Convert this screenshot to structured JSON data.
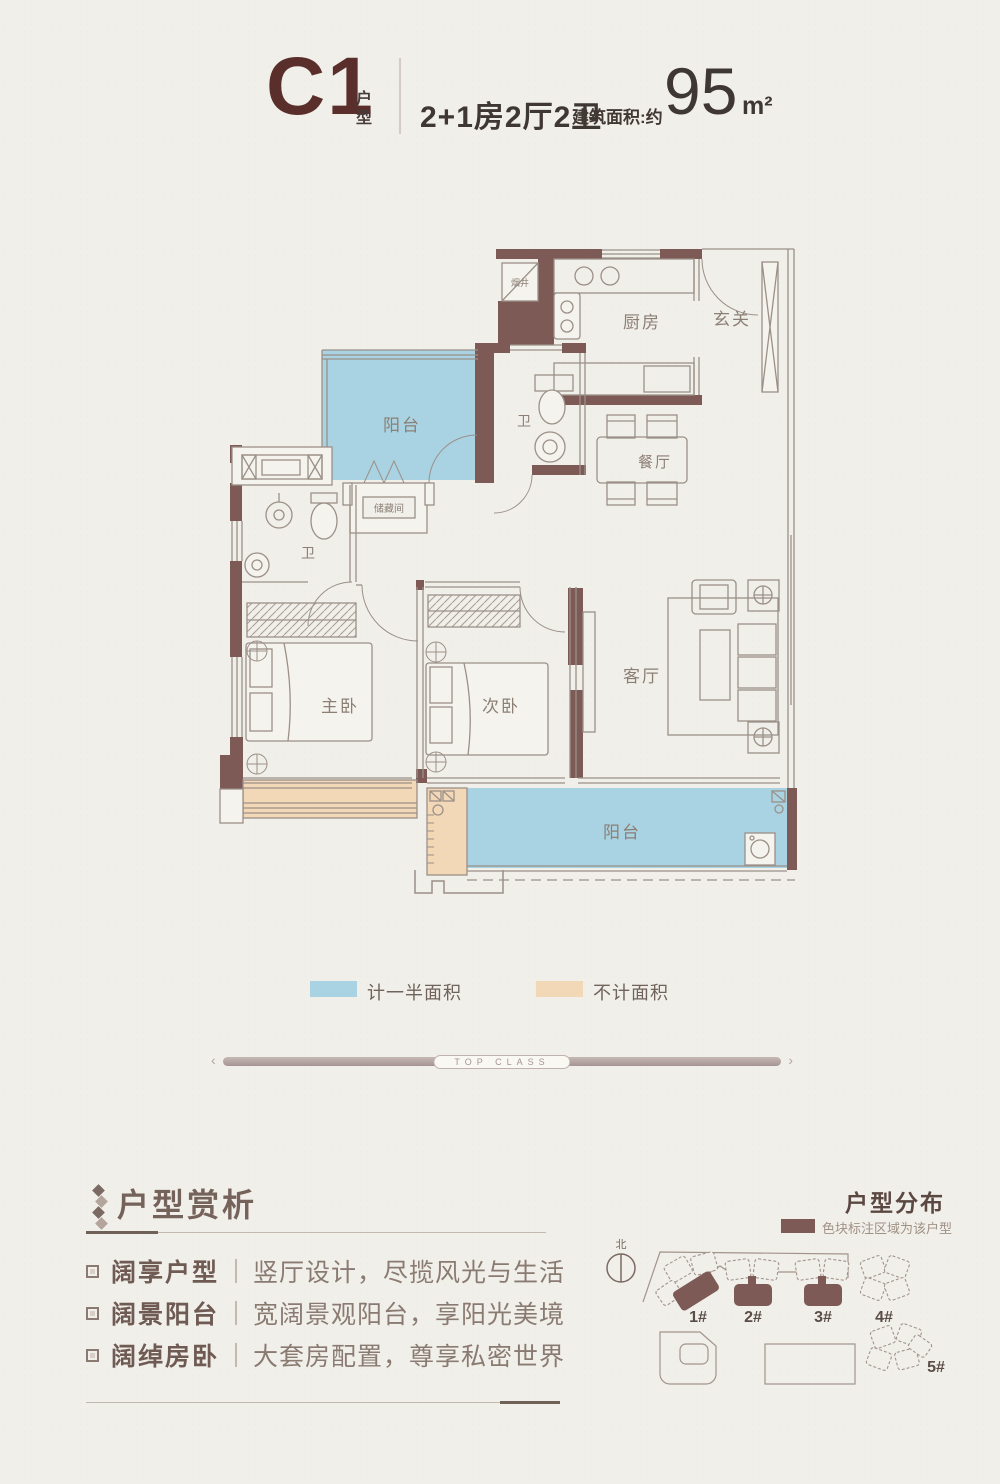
{
  "header": {
    "unit_code": "C1",
    "unit_type_line1": "户",
    "unit_type_line2": "型",
    "layout_spec": "2+1房2厅2卫",
    "area_label": "建筑面积:约",
    "area_value": "95",
    "area_unit": "m²"
  },
  "floorplan": {
    "rooms": {
      "smoke_shaft": "烟井",
      "kitchen": "厨房",
      "foyer": "玄关",
      "dining": "餐厅",
      "balcony_top": "阳台",
      "bath_main": "卫",
      "storage": "储藏间",
      "bath_left": "卫",
      "master_bedroom": "主卧",
      "second_bedroom": "次卧",
      "living": "客厅",
      "balcony_bottom": "阳台"
    },
    "colors": {
      "wall": "#7d5a55",
      "half_area_fill": "#a9d3e2",
      "excluded_fill": "#f3d8b7",
      "line": "#9b9088"
    }
  },
  "legend": {
    "items": [
      {
        "label": "计一半面积",
        "color": "#a9d3e2"
      },
      {
        "label": "不计面积",
        "color": "#f3d8b7"
      }
    ]
  },
  "divider": {
    "text": "TOP CLASS"
  },
  "analysis": {
    "title": "户型赏析",
    "items": [
      {
        "term": "阔享户型",
        "desc": "竖厅设计，尽揽风光与生活"
      },
      {
        "term": "阔景阳台",
        "desc": "宽阔景观阳台，享阳光美境"
      },
      {
        "term": "阔绰房卧",
        "desc": "大套房配置，尊享私密世界"
      }
    ]
  },
  "distribution": {
    "title": "户型分布",
    "legend_label": "色块标注区域为该户型",
    "north_label": "北",
    "buildings": [
      "1#",
      "2#",
      "3#",
      "4#",
      "5#"
    ]
  }
}
